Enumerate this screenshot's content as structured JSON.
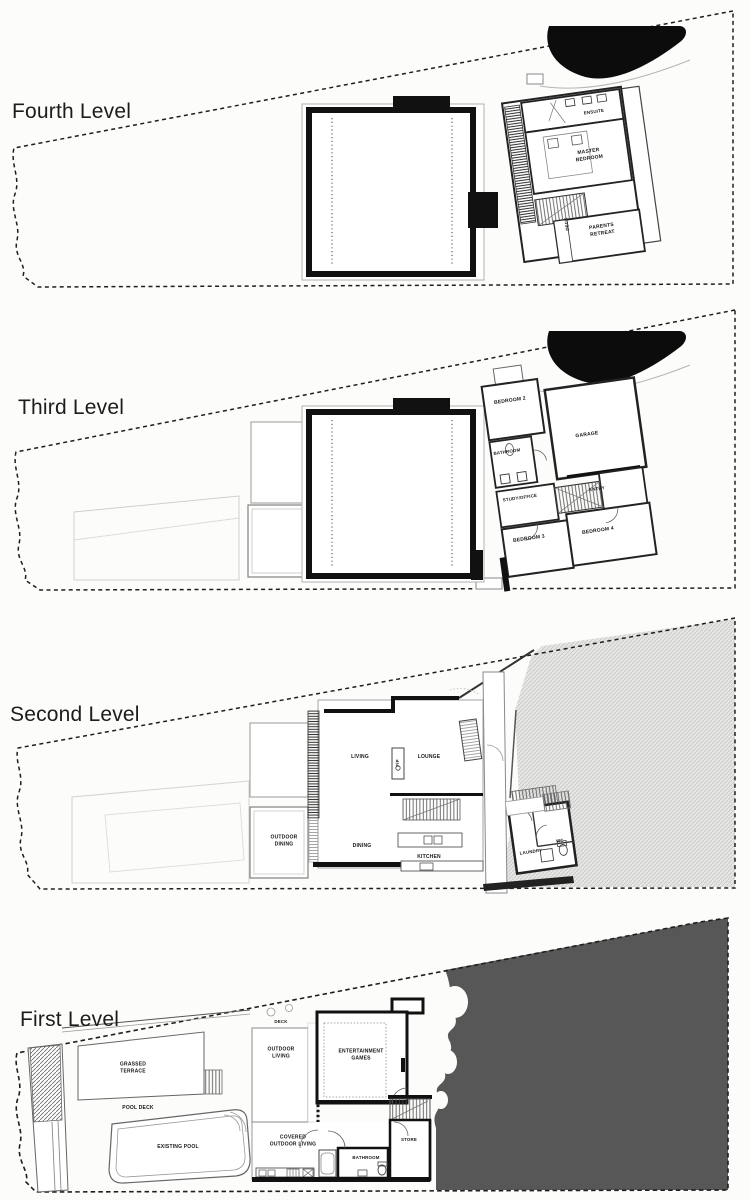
{
  "document": {
    "background": "#fcfcfa",
    "ink": "#111111",
    "dark_area_fill": "#575757",
    "hatch_area_fill": "#e6e6e5"
  },
  "levels": [
    {
      "title": "Fourth Level",
      "rooms": {
        "ensuite": "ENSUITE",
        "master_bedroom": "MASTER BEDROOM",
        "deck": "DECK",
        "parents_retreat": "PARENTS RETREAT"
      }
    },
    {
      "title": "Third Level",
      "rooms": {
        "bedroom2": "BEDROOM 2",
        "garage": "GARAGE",
        "bathroom": "BATHROOM",
        "study_office": "STUDY/OFFICE",
        "entry": "ENTRY",
        "bedroom3": "BEDROOM 3",
        "bedroom4": "BEDROOM 4"
      }
    },
    {
      "title": "Second Level",
      "rooms": {
        "living": "LIVING",
        "fireplace": "F/P",
        "lounge": "LOUNGE",
        "outdoor_dining": "OUTDOOR DINING",
        "dining": "DINING",
        "kitchen": "KITCHEN",
        "laundry": "LAUNDRY",
        "wc": "WC"
      }
    },
    {
      "title": "First Level",
      "rooms": {
        "deck": "DECK",
        "outdoor_living": "OUTDOOR LIVING",
        "entertainment_games": "ENTERTAINMENT GAMES",
        "grassed_terrace": "GRASSED TERRACE",
        "pool_deck": "POOL DECK",
        "existing_pool": "EXISTING POOL",
        "covered_outdoor_living": "COVERED OUTDOOR LIVING",
        "bathroom": "BATHROOM",
        "store": "STORE"
      }
    }
  ]
}
